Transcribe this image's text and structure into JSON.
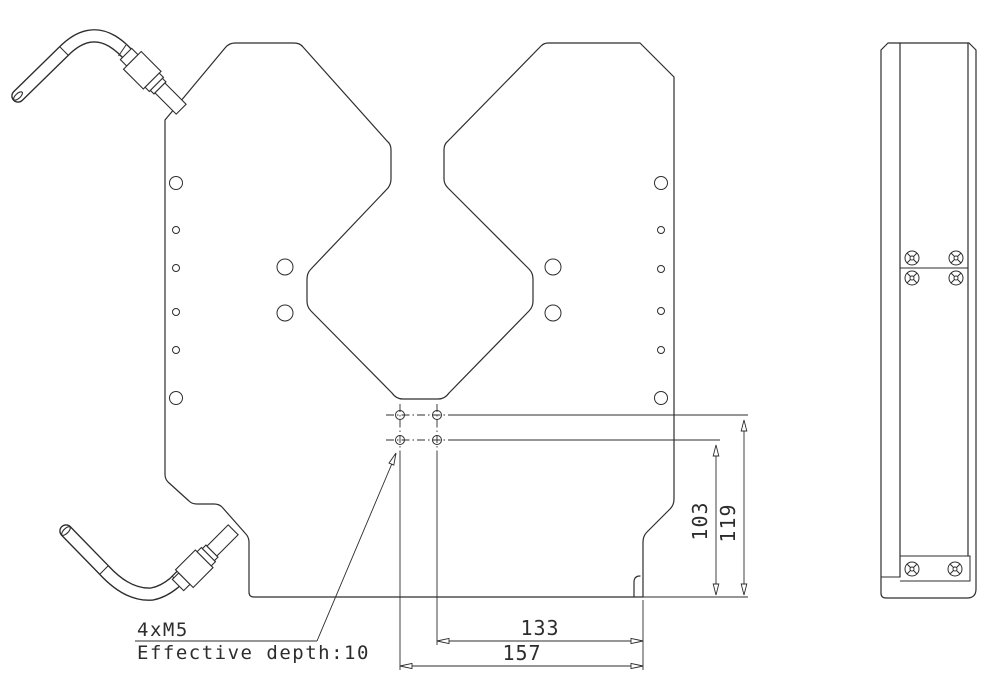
{
  "drawing": {
    "labels": {
      "thread_callout": "4xM5",
      "depth_note": "Effective depth:10"
    },
    "dimensions": {
      "vertical_inner": "103",
      "vertical_outer": "119",
      "horizontal_inner": "133",
      "horizontal_outer": "157"
    },
    "colors": {
      "line": "#2d2d2d",
      "background": "#ffffff"
    }
  }
}
